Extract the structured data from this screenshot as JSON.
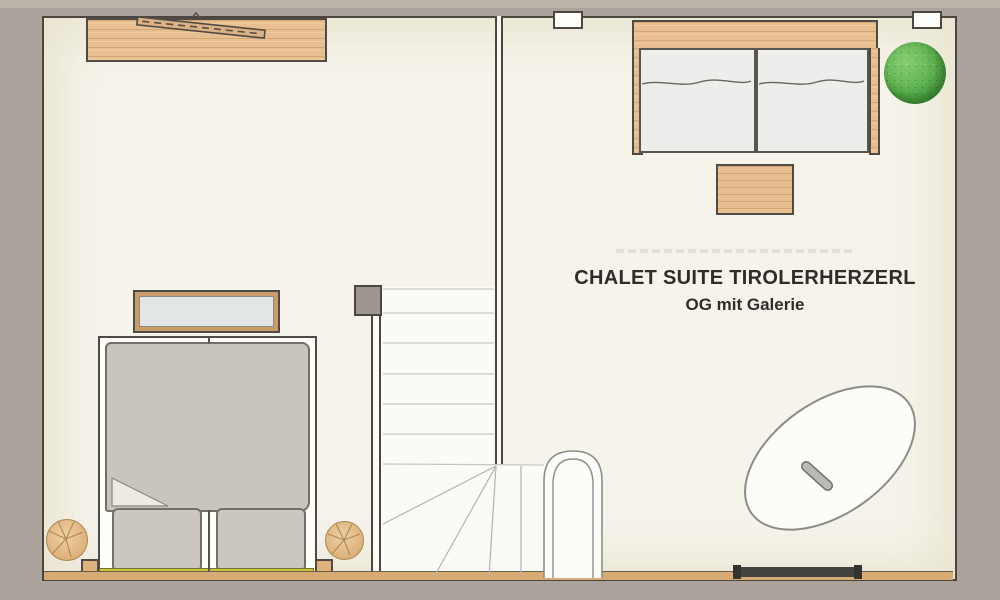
{
  "title": {
    "suite_name": "CHALET SUITE TIROLERHERZERL",
    "floor_label": "OG mit Galerie"
  },
  "colors": {
    "exterior_matte": "#aca49c",
    "floor": "#f5f3ea",
    "stair_floor": "#fafbf7",
    "wall_line": "#4c463f",
    "wood": "#e7bf90",
    "bedding_grey": "#c9c5bd",
    "mattress_white": "#ededeb",
    "headboard_yellow": "#cbc23a",
    "plant_green": "#55ab49",
    "dark_window": "#44433d"
  },
  "furniture_symbols": [
    "sideboard-top-left",
    "ski-on-sideboard",
    "bench",
    "double-bed-lower-left",
    "duvet",
    "pillows",
    "log-stools",
    "corner-posts",
    "staircase-with-winder-steps",
    "newel-post",
    "curved-handrail",
    "double-bed-upper-right",
    "side-table",
    "potted-plant",
    "oval-rug",
    "top-wall-windows",
    "dark-picture-window"
  ]
}
